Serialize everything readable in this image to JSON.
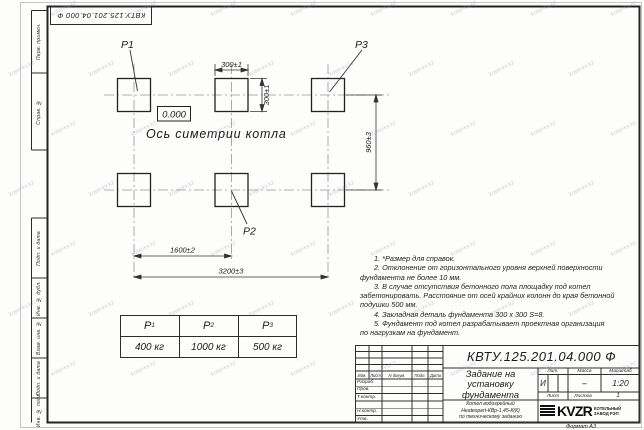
{
  "sheet": {
    "top_stamp": "КВТУ.125.201.04.000  Ф",
    "format_label": "Формат А3",
    "watermark_text": "kotel-kv.kz"
  },
  "left_margin": {
    "top_cells": [
      "Перв. примен.",
      "Справ. №"
    ],
    "bottom_cells": [
      "Подп. и дата",
      "Инв. № дубл.",
      "Взам. инв. №",
      "Подп. и дата",
      "Инв. № подл."
    ]
  },
  "drawing": {
    "point_labels": {
      "p1": "P1",
      "p2": "P2",
      "p3": "P3"
    },
    "elevation": "0.000",
    "axis_caption": "Ось симетрии котла",
    "dim_pad_width": "300±1",
    "dim_pad_height": "300±1",
    "dim_row_spacing": "960±3",
    "dim_col_spacing": "1600±2",
    "dim_total": "3200±3"
  },
  "notes": {
    "lines": [
      "1.  *Размер для справок.",
      "2.  Отклонение от горизонтального уровня верхней поверхности",
      "фундамента не более 10 мм.",
      "3.  В случае отсутствия бетонного пола площадку под котел",
      "забетонировать. Расстояние от осей крайних колонн до края бетонной",
      "подушки 500 мм.",
      "4.  Закладная деталь фундамента  300 х 300  S=8.",
      "5.  Фундамент под котел разрабатывает проектная организация",
      "по нагрузкам на фундамент."
    ]
  },
  "load_table": {
    "columns": [
      {
        "sym": "P",
        "idx": "1",
        "value": "400 кг"
      },
      {
        "sym": "P",
        "idx": "2",
        "value": "1000 кг"
      },
      {
        "sym": "P",
        "idx": "3",
        "value": "500 кг"
      }
    ]
  },
  "title_block": {
    "designation": "КВТУ.125.201.04.000  Ф",
    "title_lines": [
      "Задание на",
      "установку",
      "фундамента"
    ],
    "subtitle_lines": [
      "Котел водогрейный",
      "Heatexpert-КВр-1,45-К(К)",
      "по техническому заданию"
    ],
    "header_cols": [
      "Изм.",
      "Лист",
      "N докум.",
      "Подп.",
      "Дата"
    ],
    "staff_rows": [
      "Разраб.",
      "Пров.",
      "Т.контр.",
      "",
      "Н.контр.",
      "Утв."
    ],
    "lit_label": "Лит.",
    "mass_label": "Масса",
    "scale_label": "Масштаб",
    "lit_value": "И",
    "mass_value": "–",
    "scale_value": "1:20",
    "sheet_label": "Лист",
    "sheets_label": "Листов",
    "sheets_value": "1",
    "logo_text": "KVZR",
    "logo_caption_lines": [
      "КОТЕЛЬНЫЙ",
      "ЗАВОД РЭП"
    ]
  }
}
